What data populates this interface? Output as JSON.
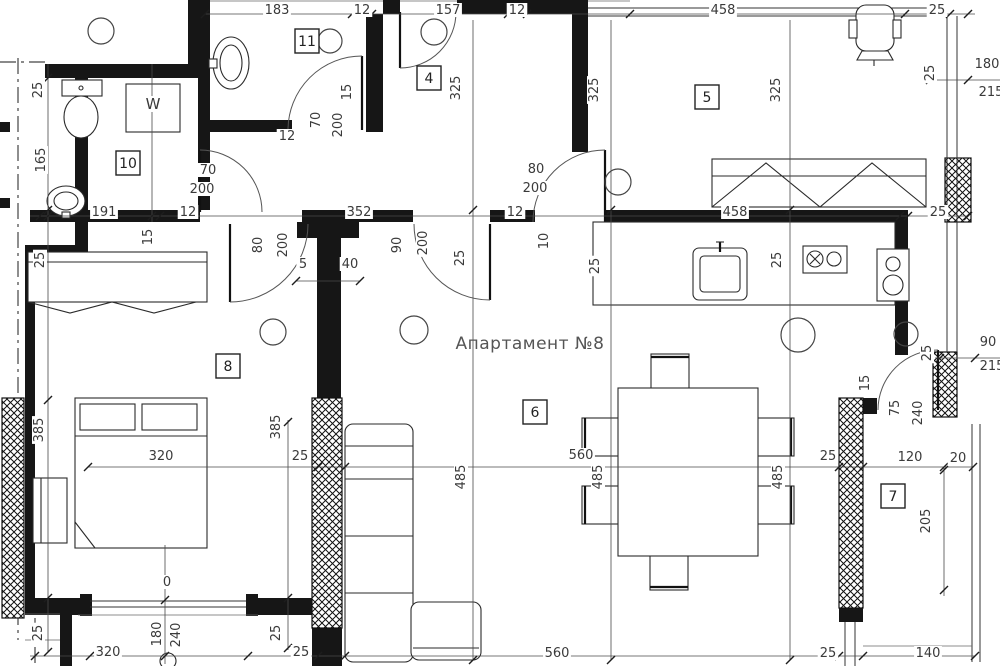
{
  "title": "Апартамент №8",
  "colors": {
    "wall": "#161616",
    "dim_line": "#4a4a4a",
    "text": "#3a3a3a",
    "background": "#ffffff"
  },
  "room_numbers": [
    {
      "n": "11",
      "x": 307,
      "y": 41
    },
    {
      "n": "4",
      "x": 429,
      "y": 78
    },
    {
      "n": "5",
      "x": 707,
      "y": 97
    },
    {
      "n": "10",
      "x": 128,
      "y": 163
    },
    {
      "n": "8",
      "x": 228,
      "y": 366
    },
    {
      "n": "6",
      "x": 535,
      "y": 412
    },
    {
      "n": "7",
      "x": 893,
      "y": 496
    }
  ],
  "labels": [
    {
      "t": "183",
      "x": 277,
      "y": 14
    },
    {
      "t": "12",
      "x": 362,
      "y": 14
    },
    {
      "t": "157",
      "x": 448,
      "y": 14
    },
    {
      "t": "12",
      "x": 517,
      "y": 14
    },
    {
      "t": "458",
      "x": 723,
      "y": 14
    },
    {
      "t": "25",
      "x": 937,
      "y": 14
    },
    {
      "t": "191",
      "x": 104,
      "y": 216
    },
    {
      "t": "12",
      "x": 188,
      "y": 216
    },
    {
      "t": "352",
      "x": 359,
      "y": 216
    },
    {
      "t": "12",
      "x": 515,
      "y": 216
    },
    {
      "t": "458",
      "x": 735,
      "y": 216
    },
    {
      "t": "25",
      "x": 938,
      "y": 216
    },
    {
      "t": "25",
      "x": 42,
      "y": 90,
      "r": -90
    },
    {
      "t": "165",
      "x": 45,
      "y": 160,
      "r": -90
    },
    {
      "t": "25",
      "x": 44,
      "y": 260,
      "r": -90
    },
    {
      "t": "385",
      "x": 43,
      "y": 430,
      "r": -90
    },
    {
      "t": "25",
      "x": 42,
      "y": 633,
      "r": -90
    },
    {
      "t": "320",
      "x": 108,
      "y": 656
    },
    {
      "t": "25",
      "x": 301,
      "y": 656
    },
    {
      "t": "560",
      "x": 557,
      "y": 657
    },
    {
      "t": "25",
      "x": 828,
      "y": 657
    },
    {
      "t": "140",
      "x": 928,
      "y": 657
    },
    {
      "t": "385",
      "x": 280,
      "y": 427,
      "r": -90
    },
    {
      "t": "25",
      "x": 280,
      "y": 633,
      "r": -90
    },
    {
      "t": "180",
      "x": 161,
      "y": 634,
      "r": -90
    },
    {
      "t": "240",
      "x": 180,
      "y": 635,
      "r": -90
    },
    {
      "t": "0",
      "x": 167,
      "y": 586
    },
    {
      "t": "320",
      "x": 161,
      "y": 460
    },
    {
      "t": "25",
      "x": 300,
      "y": 460
    },
    {
      "t": "560",
      "x": 581,
      "y": 459
    },
    {
      "t": "25",
      "x": 828,
      "y": 460
    },
    {
      "t": "120",
      "x": 910,
      "y": 461
    },
    {
      "t": "20",
      "x": 958,
      "y": 462
    },
    {
      "t": "485",
      "x": 465,
      "y": 477,
      "r": -90
    },
    {
      "t": "485",
      "x": 602,
      "y": 477,
      "r": -90
    },
    {
      "t": "485",
      "x": 782,
      "y": 477,
      "r": -90
    },
    {
      "t": "325",
      "x": 460,
      "y": 88,
      "r": -90
    },
    {
      "t": "325",
      "x": 598,
      "y": 90,
      "r": -90
    },
    {
      "t": "325",
      "x": 780,
      "y": 90,
      "r": -90
    },
    {
      "t": "70",
      "x": 320,
      "y": 120,
      "r": -90
    },
    {
      "t": "200",
      "x": 342,
      "y": 125,
      "r": -90
    },
    {
      "t": "15",
      "x": 351,
      "y": 92,
      "r": -90
    },
    {
      "t": "12",
      "x": 287,
      "y": 140
    },
    {
      "t": "70",
      "x": 208,
      "y": 174
    },
    {
      "t": "200",
      "x": 202,
      "y": 193
    },
    {
      "t": "80",
      "x": 536,
      "y": 173
    },
    {
      "t": "200",
      "x": 535,
      "y": 192
    },
    {
      "t": "80",
      "x": 262,
      "y": 245,
      "r": -90
    },
    {
      "t": "200",
      "x": 287,
      "y": 245,
      "r": -90
    },
    {
      "t": "90",
      "x": 401,
      "y": 245,
      "r": -90
    },
    {
      "t": "200",
      "x": 427,
      "y": 243,
      "r": -90
    },
    {
      "t": "5",
      "x": 303,
      "y": 268
    },
    {
      "t": "40",
      "x": 350,
      "y": 268
    },
    {
      "t": "15",
      "x": 152,
      "y": 237,
      "r": -90
    },
    {
      "t": "10",
      "x": 548,
      "y": 241,
      "r": -90
    },
    {
      "t": "25",
      "x": 464,
      "y": 258,
      "r": -90
    },
    {
      "t": "25",
      "x": 599,
      "y": 266,
      "r": -90
    },
    {
      "t": "25",
      "x": 781,
      "y": 260,
      "r": -90
    },
    {
      "t": "25",
      "x": 934,
      "y": 73,
      "r": -90
    },
    {
      "t": "180",
      "x": 987,
      "y": 68
    },
    {
      "t": "215",
      "x": 991,
      "y": 96
    },
    {
      "t": "90",
      "x": 988,
      "y": 346
    },
    {
      "t": "215",
      "x": 992,
      "y": 370
    },
    {
      "t": "25",
      "x": 931,
      "y": 353,
      "r": -90
    },
    {
      "t": "15",
      "x": 869,
      "y": 383,
      "r": -90
    },
    {
      "t": "75",
      "x": 899,
      "y": 408,
      "r": -90
    },
    {
      "t": "240",
      "x": 922,
      "y": 413,
      "r": -90
    },
    {
      "t": "205",
      "x": 930,
      "y": 521,
      "r": -90
    },
    {
      "t": "W",
      "x": 153,
      "y": 109,
      "s": 15
    }
  ]
}
